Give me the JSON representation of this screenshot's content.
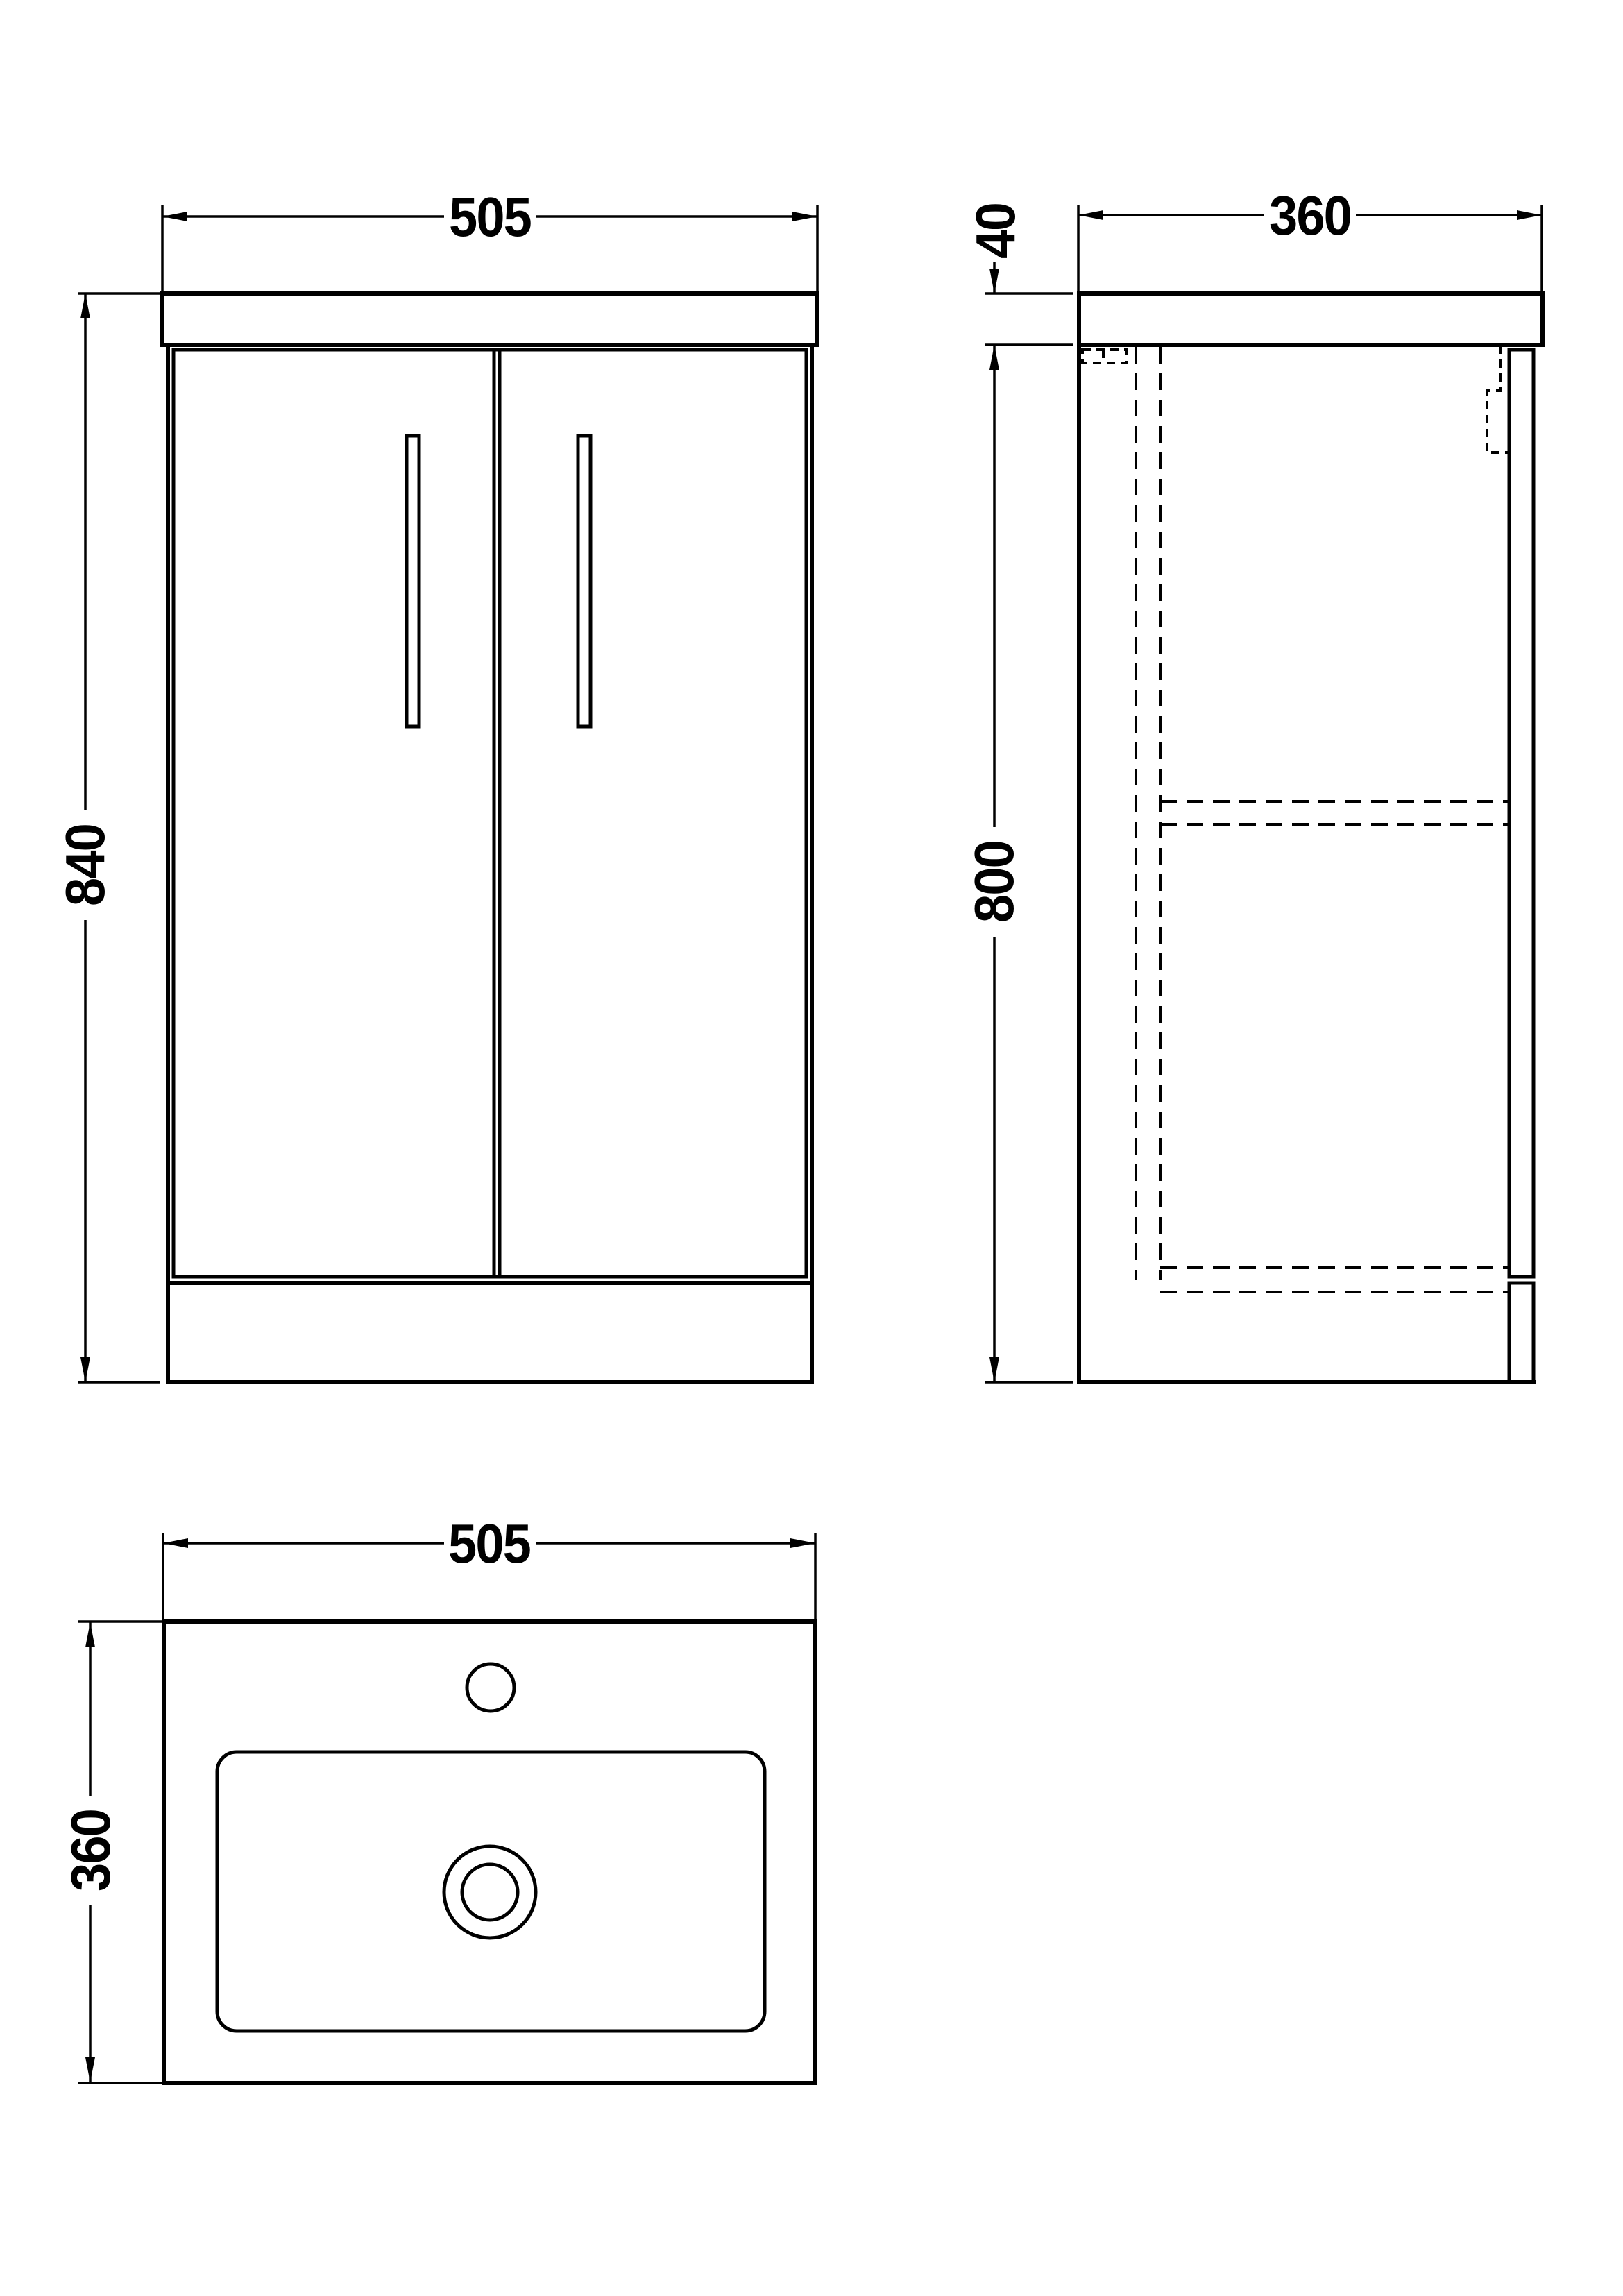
{
  "drawing": {
    "background_color": "#ffffff",
    "line_color": "#000000",
    "views": {
      "front": {
        "name": "front-elevation",
        "width_label": "505",
        "height_label": "840"
      },
      "side": {
        "name": "side-elevation",
        "depth_label": "360",
        "worktop_thickness_label": "40",
        "carcass_height_label": "800"
      },
      "plan": {
        "name": "basin-plan",
        "width_label": "505",
        "depth_label": "360"
      }
    }
  }
}
